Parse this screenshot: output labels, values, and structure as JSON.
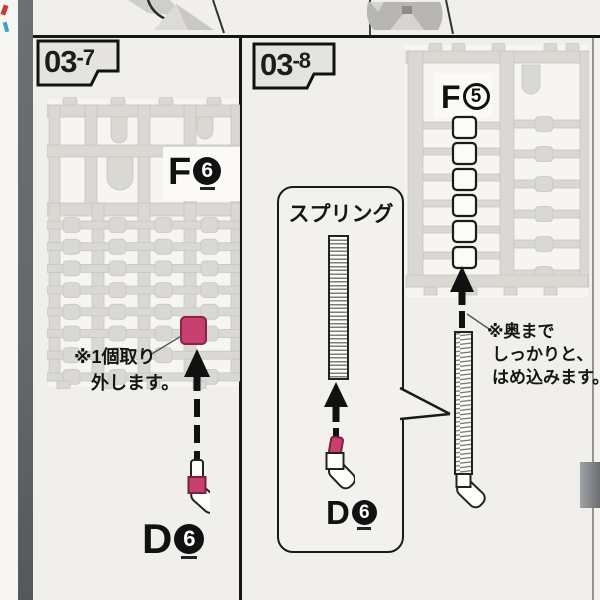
{
  "left_panel": {
    "badge": {
      "number": "03",
      "sub": "-7"
    },
    "sprue_label": {
      "letter": "F",
      "number": "6"
    },
    "note": {
      "line1": "※1個取り",
      "line2": "外します。"
    },
    "part_label": {
      "letter": "D",
      "number": "6"
    }
  },
  "right_panel": {
    "badge": {
      "number": "03",
      "sub": "-8"
    },
    "box_title": "スプリング",
    "part_label": {
      "letter": "D",
      "number": "6"
    },
    "sprue_label": {
      "letter": "F",
      "number": "5"
    },
    "note": {
      "line1": "※奥まで",
      "line2": "しっかりと、",
      "line3": "はめ込みます。"
    }
  },
  "colors": {
    "highlight_pink": "#c8406f",
    "page_background": "#f0efeb",
    "spine_gray": "#6a6d70",
    "sprue_gray": "#d9d8d2",
    "line_black": "#1a1a1a"
  }
}
